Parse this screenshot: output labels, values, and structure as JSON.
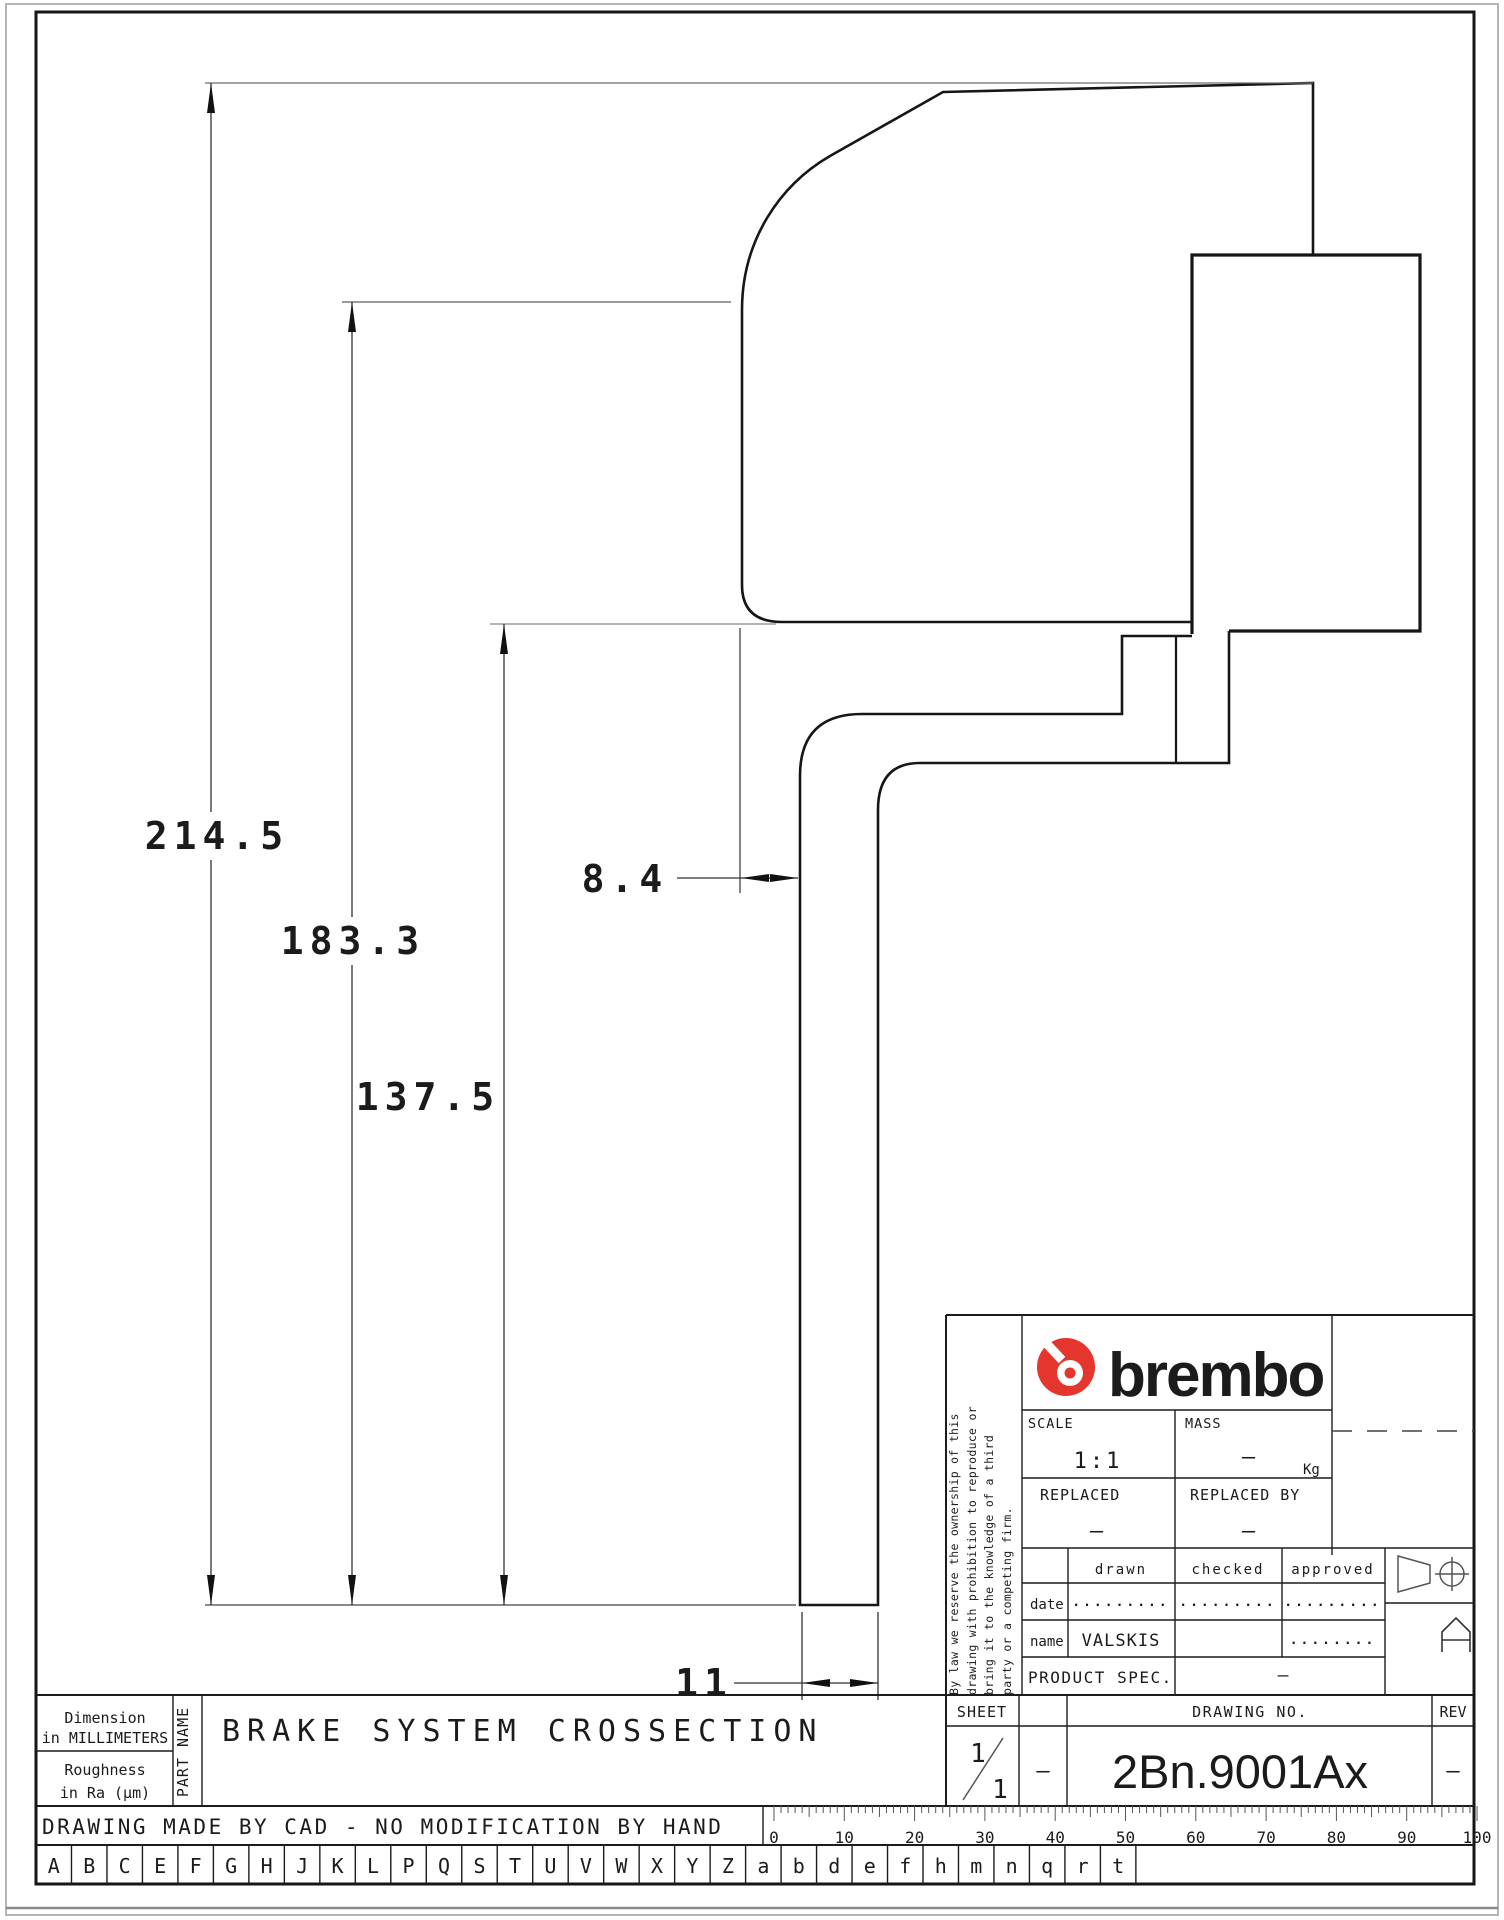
{
  "drawing": {
    "dims": {
      "total_height": "214.5",
      "upper_height": "183.3",
      "lower_height": "137.5",
      "wall_offset": "8.4",
      "leg_width": "11"
    }
  },
  "title_block": {
    "brand": "brembo",
    "scale_label": "SCALE",
    "scale_value": "1:1",
    "mass_label": "MASS",
    "mass_value": "–",
    "mass_unit": "Kg",
    "replaced_label": "REPLACED",
    "replaced_value": "–",
    "replaced_by_label": "REPLACED BY",
    "replaced_by_value": "–",
    "col_drawn": "drawn",
    "col_checked": "checked",
    "col_approved": "approved",
    "row_date": "date",
    "row_name": "name",
    "date_drawn": ".........",
    "date_checked": ".........",
    "date_approved": ".........",
    "name_drawn": "VALSKIS",
    "name_checked": "",
    "name_approved": "........",
    "product_label": "PRODUCT SPEC.",
    "product_value": "–",
    "sheet_label": "SHEET",
    "sheet_num": "1",
    "sheet_den": "1",
    "sheet_extra": "–",
    "drawing_no_label": "DRAWING NO.",
    "drawing_no_value": "2Bn.9001Ax",
    "rev_label": "REV",
    "rev_value": "–",
    "format_letter": "A",
    "disclaimer_lines": [
      "By law we reserve the ownership of this",
      "drawing with prohibition to reproduce or",
      "bring it to the knowledge of a third",
      "party or a competing firm."
    ]
  },
  "footer": {
    "dimension_line1": "Dimension",
    "dimension_line2": "in MILLIMETERS",
    "roughness_line1": "Roughness",
    "roughness_line2": "in Ra (µm)",
    "part_name_label": "PART NAME",
    "part_name": "BRAKE SYSTEM CROSSECTION",
    "cad_note": "DRAWING MADE BY CAD - NO MODIFICATION BY HAND",
    "letters": [
      "A",
      "B",
      "C",
      "E",
      "F",
      "G",
      "H",
      "J",
      "K",
      "L",
      "P",
      "Q",
      "S",
      "T",
      "U",
      "V",
      "W",
      "X",
      "Y",
      "Z",
      "a",
      "b",
      "d",
      "e",
      "f",
      "h",
      "m",
      "n",
      "q",
      "r",
      "t"
    ],
    "ruler_labels": [
      "0",
      "10",
      "20",
      "30",
      "40",
      "50",
      "60",
      "70",
      "80",
      "90",
      "100"
    ]
  },
  "colors": {
    "brand_red": "#e5362e",
    "line": "#161616",
    "gray": "#9b9b9b"
  }
}
